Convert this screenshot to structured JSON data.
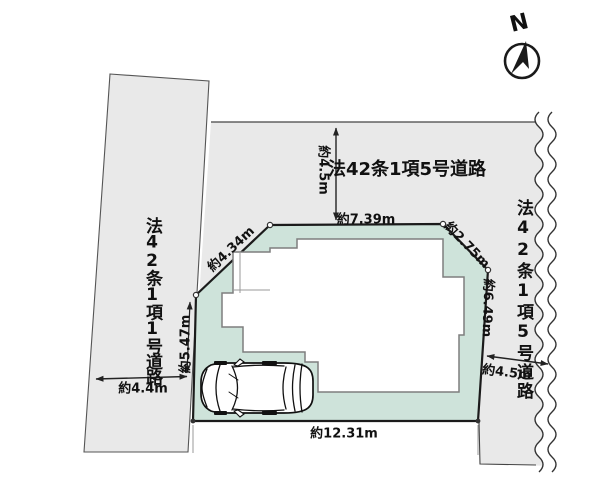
{
  "compass": {
    "north_label": "N"
  },
  "roads": {
    "top": {
      "label": "法42条1項5号道路",
      "width_dim": "約4.5m"
    },
    "left": {
      "label": "法42条1項1号道路",
      "width_dim": "約4.4m"
    },
    "right": {
      "label": "法42条1項5号道路",
      "width_dim": "約4.5m"
    }
  },
  "lot": {
    "edge_dims": {
      "top": "約7.39m",
      "top_left_diagonal": "約4.34m",
      "top_right_diagonal": "約2.75m",
      "right": "約6.49m",
      "left": "約5.47m",
      "bottom": "約12.31m"
    }
  },
  "colors": {
    "road_fill": "#e9e9e9",
    "lot_fill": "#cee3da",
    "line": "#1a1a1a"
  }
}
